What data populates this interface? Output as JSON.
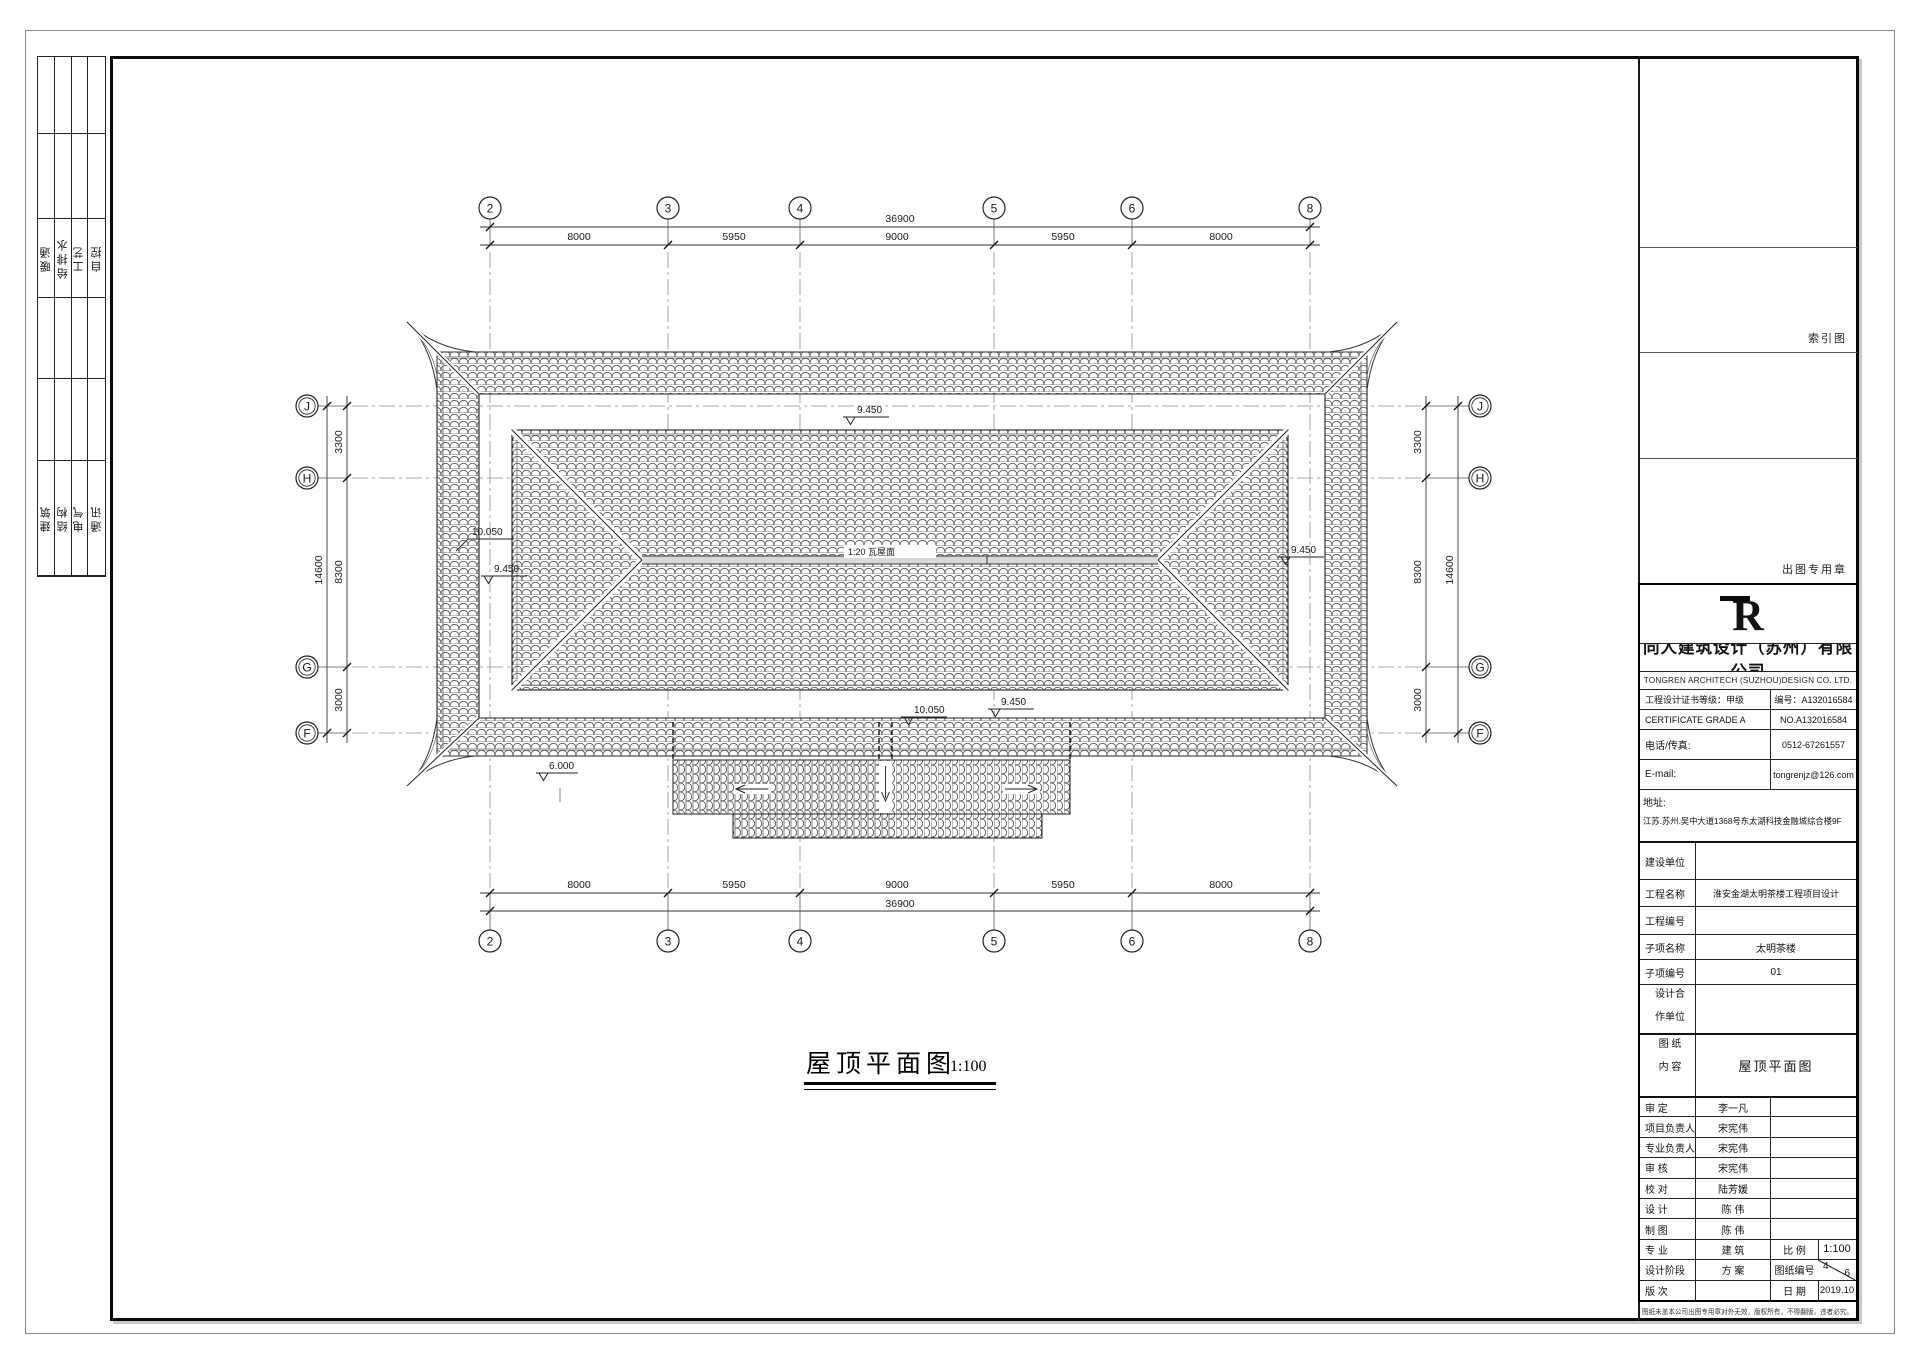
{
  "sheet": {
    "left_strip": {
      "group1": [
        "暖通",
        "给排水",
        "工艺",
        "自控"
      ],
      "group2": [
        "建筑",
        "结构",
        "电气",
        "通讯"
      ]
    },
    "right_column": {
      "index_label": "索引图",
      "stamp_label": "出图专用章"
    },
    "footnote": "图纸未盖本公司出图专用章对外无效，版权所有，不得翻版，违者必究。"
  },
  "drawing": {
    "title": "屋顶平面图",
    "scale": "1:100",
    "axes": {
      "cols": [
        "2",
        "3",
        "4",
        "5",
        "6",
        "8"
      ],
      "rows": [
        "J",
        "H",
        "G",
        "F"
      ]
    },
    "dims": {
      "top_total": "36900",
      "top_segments": [
        "8000",
        "5950",
        "9000",
        "5950",
        "8000"
      ],
      "bottom_total": "36900",
      "bottom_segments": [
        "8000",
        "5950",
        "9000",
        "5950",
        "8000"
      ],
      "left_total": "14600",
      "left_segments": [
        "3300",
        "8300",
        "3000"
      ],
      "right_total": "14600",
      "right_segments": [
        "3300",
        "8300",
        "3000"
      ]
    },
    "annotations": {
      "ridge": "1:20 瓦屋面",
      "elev_top": "9.450",
      "elev_left_upper": "10.050",
      "elev_left_lower": "9.450",
      "elev_right": "9.450",
      "elev_bottom_left": "10.050",
      "elev_bottom_right": "9.450",
      "elev_porch": "6.000"
    }
  },
  "title_block": {
    "logo": "R",
    "company_cn": "同人建筑设计（苏州）有限公司",
    "company_en": "TONGREN ARCHITECH (SUZHOU)DESIGN CO. LTD.",
    "cert_grade_label": "工程设计证书等级：甲级",
    "cert_no_label": "编号：A132016584",
    "cert_grade_en": "CERTIFICATE GRADE A",
    "cert_no_en": "NO.A132016584",
    "phone_label": "电话/传真:",
    "phone": "0512-67261557",
    "email_label": "E-mail:",
    "email": "tongrenjz@126.com",
    "addr_label": "地址:",
    "address": "江苏.苏州.吴中大道1368号东太湖科技金融城综合楼9F",
    "rows": [
      {
        "label": "建设单位",
        "value": ""
      },
      {
        "label": "工程名称",
        "value": "淮安金湖太明茶楼工程项目设计"
      },
      {
        "label": "工程编号",
        "value": ""
      },
      {
        "label": "子项名称",
        "value": "太明茶楼"
      },
      {
        "label": "子项编号",
        "value": "01"
      }
    ],
    "partner_label1": "设计合",
    "partner_label2": "作单位",
    "content_label1": "图  纸",
    "content_label2": "内  容",
    "content_value": "屋顶平面图",
    "people": [
      {
        "label": "审  定",
        "value": "李一凡"
      },
      {
        "label": "项目负责人",
        "value": "宋宪伟"
      },
      {
        "label": "专业负责人",
        "value": "宋宪伟"
      },
      {
        "label": "审  核",
        "value": "宋宪伟"
      },
      {
        "label": "校  对",
        "value": "陆芳媛"
      },
      {
        "label": "设  计",
        "value": "陈  伟"
      },
      {
        "label": "制  图",
        "value": "陈  伟"
      }
    ],
    "bottom": [
      {
        "label": "专  业",
        "value": "建 筑",
        "label2": "比  例",
        "value2": "1:100"
      },
      {
        "label": "设计阶段",
        "value": "方 案",
        "label2": "图纸编号",
        "sheet_no": "4",
        "sheet_total": "6"
      },
      {
        "label": "版  次",
        "value": "",
        "label2": "日  期",
        "value2": "2019.10"
      }
    ]
  }
}
